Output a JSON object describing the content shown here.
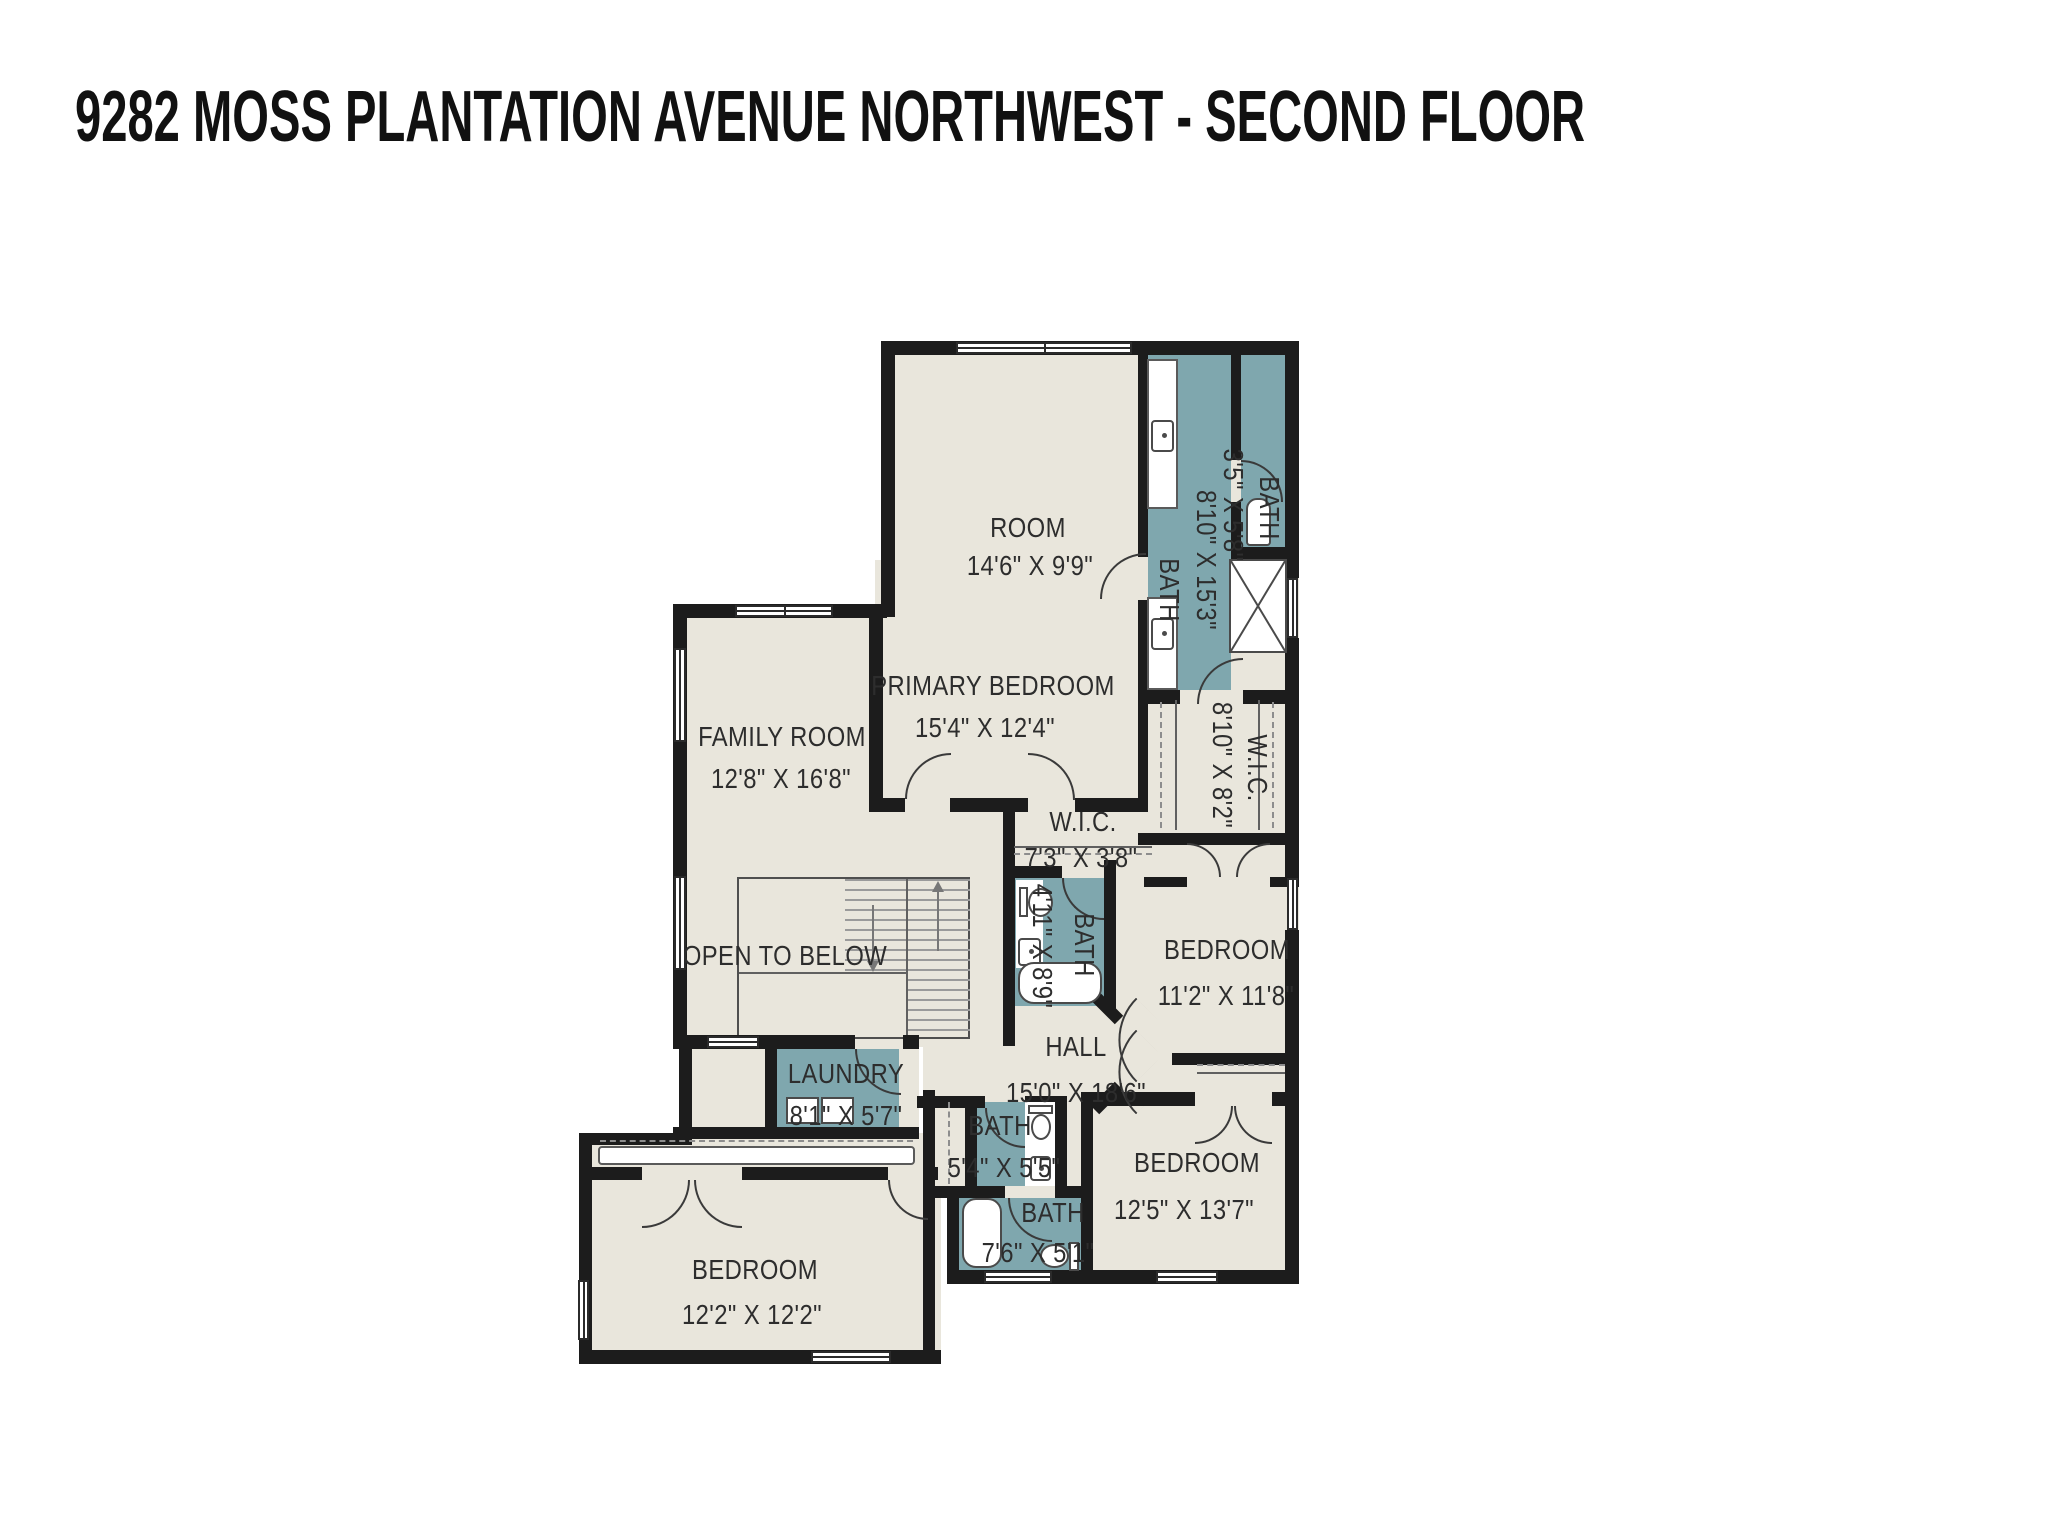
{
  "title": "9282 MOSS PLANTATION AVENUE NORTHWEST - SECOND FLOOR",
  "colors": {
    "background": "#ffffff",
    "floor": "#e9e6dc",
    "wet_room": "#7fa7ae",
    "wall": "#1c1c1c",
    "label_text": "#2d2d2d"
  },
  "rooms": {
    "room": {
      "name": "ROOM",
      "dims": "14'6\" X 9'9\""
    },
    "primary_bedroom": {
      "name": "PRIMARY BEDROOM",
      "dims": "15'4\" X 12'4\""
    },
    "family_room": {
      "name": "FAMILY ROOM",
      "dims": "12'8\" X 16'8\""
    },
    "primary_bath": {
      "name": "BATH",
      "dims": "8'10\" X 15'3\""
    },
    "corner_bath": {
      "name": "BATH",
      "dims": "3'5\" X 5'8\""
    },
    "wic_primary": {
      "name": "W.I.C.",
      "dims": "8'10\" X 8'2\""
    },
    "wic_hall": {
      "name": "W.I.C.",
      "dims": "7'3\" X 3'8\""
    },
    "hall_bath": {
      "name": "BATH",
      "dims": "4'11\" X 8'9\""
    },
    "bedroom_ne": {
      "name": "BEDROOM",
      "dims": "11'2\" X 11'8\""
    },
    "open_to_below": {
      "name": "OPEN TO BELOW"
    },
    "hall": {
      "name": "HALL",
      "dims": "15'0\" X 18'6\""
    },
    "laundry": {
      "name": "LAUNDRY",
      "dims": "8'1\" X 5'7\""
    },
    "small_bath": {
      "name": "BATH",
      "dims": "5'4\" X 5'5\""
    },
    "lower_bath": {
      "name": "BATH",
      "dims": "7'6\" X 5'1\""
    },
    "bedroom_se": {
      "name": "BEDROOM",
      "dims": "12'5\" X 13'7\""
    },
    "bedroom_sw": {
      "name": "BEDROOM",
      "dims": "12'2\" X 12'2\""
    }
  },
  "icons": {
    "toilet": "tank+oval bowl shape",
    "sink": "rounded square with faucet dot",
    "bathtub": "rounded white rectangle",
    "shower": "white square with X",
    "washer_dryer": "white squares",
    "stairs_up_arrow": "▲",
    "stairs_down_arrow": "▼",
    "window": "white bar with center line",
    "door": "quarter-circle arc",
    "closet_rail": "dashed line"
  }
}
